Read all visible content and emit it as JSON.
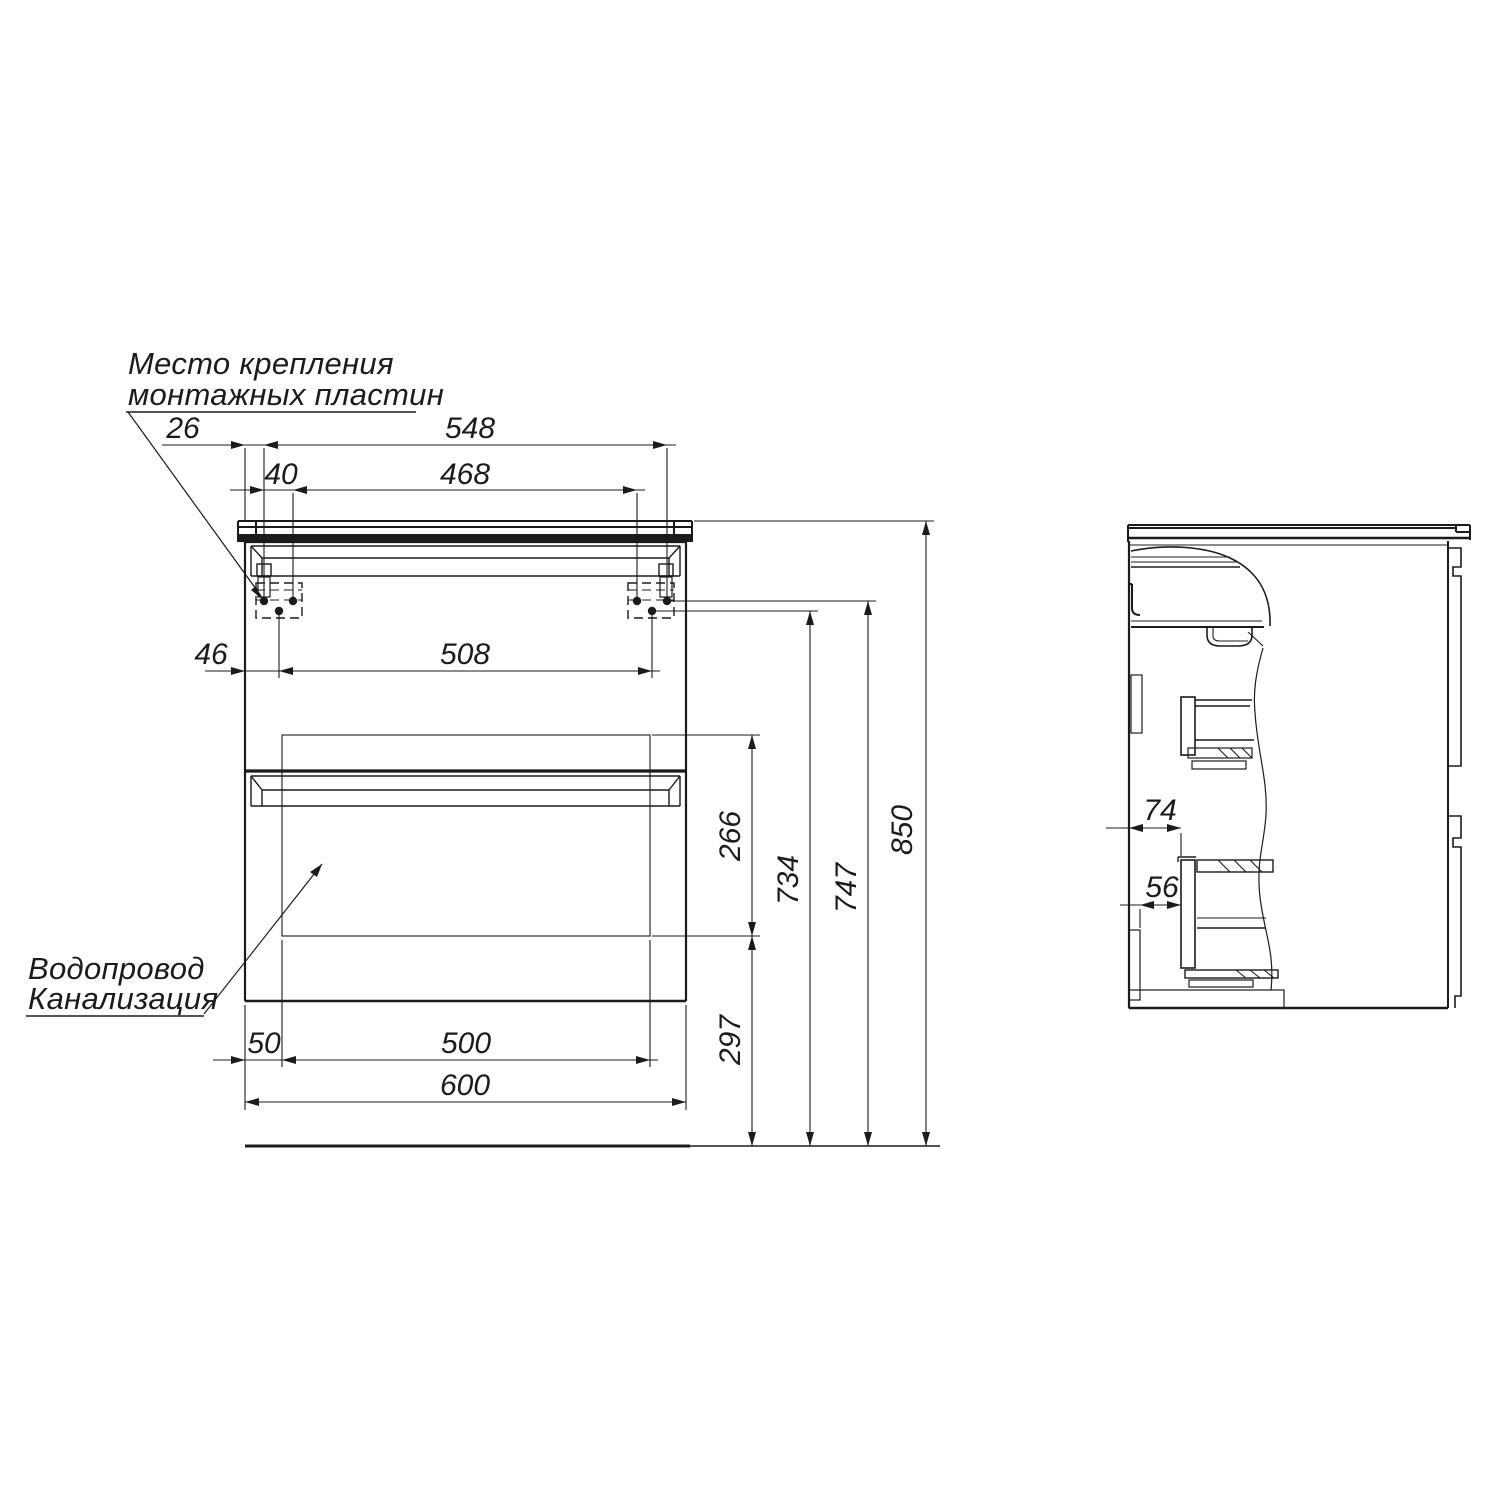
{
  "page": {
    "background": "#ffffff",
    "line_color": "#1b1b1b"
  },
  "annotations": {
    "mounting_note_line1": "Место крепления",
    "mounting_note_line2": "монтажных пластин",
    "plumbing_note_line1": "Водопровод",
    "plumbing_note_line2": "Канализация"
  },
  "front_view": {
    "dims": {
      "edge_to_first_hole": "26",
      "outer_holes_span": "548",
      "hole_pair_spacing": "40",
      "inner_holes_span": "468",
      "edge_to_lower_hole": "46",
      "lower_holes_span": "508",
      "service_zone_height": "266",
      "lower_holes_height": "734",
      "upper_holes_height": "747",
      "worktop_height": "850",
      "service_zone_bottom_height": "297",
      "edge_to_service_zone": "50",
      "service_zone_width": "500",
      "cabinet_width": "600"
    }
  },
  "side_view": {
    "dims": {
      "front_to_drawer_front": "74",
      "wall_panel_to_drawer": "56"
    }
  }
}
